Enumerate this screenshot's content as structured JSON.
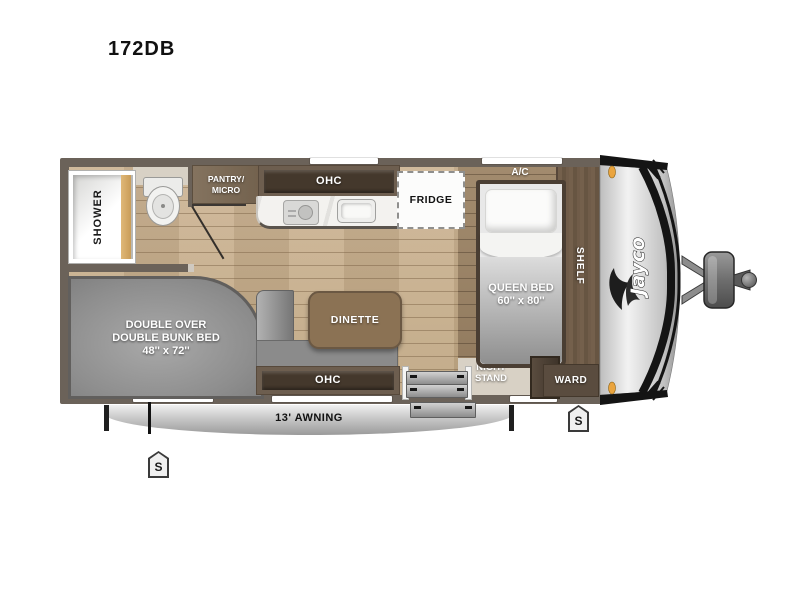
{
  "title": "172DB",
  "rooms": {
    "shower": "SHOWER",
    "pantry": "PANTRY/\nMICRO",
    "ohc_top": "OHC",
    "fridge": "FRIDGE",
    "ac": "A/C",
    "queen_bed": "QUEEN BED\n60'' x 80''",
    "shelf": "SHELF",
    "ward": "WARD",
    "night_stand": "NIGHT\nSTAND",
    "bunk": "DOUBLE OVER\nDOUBLE BUNK BED\n48'' x 72''",
    "dinette": "DINETTE",
    "ohc_bottom": "OHC",
    "awning": "13' AWNING"
  },
  "markers": {
    "stabilizer_left": "S",
    "stabilizer_right": "S"
  },
  "brand": {
    "logo": "Jayco"
  },
  "colors": {
    "wall": "#6b6259",
    "floor_main": "#c9b191",
    "floor_bedroom": "#9c8568",
    "cabinet_dark": "#44382c",
    "cabinet_mid": "#6d5e4f",
    "mattress_gray": "#9c9c9c",
    "table_brown": "#8b7254",
    "curtain_tan": "#d4a868",
    "awning_gray": "#c7c7c7",
    "clearance_light_amber": "#eaa43e"
  }
}
